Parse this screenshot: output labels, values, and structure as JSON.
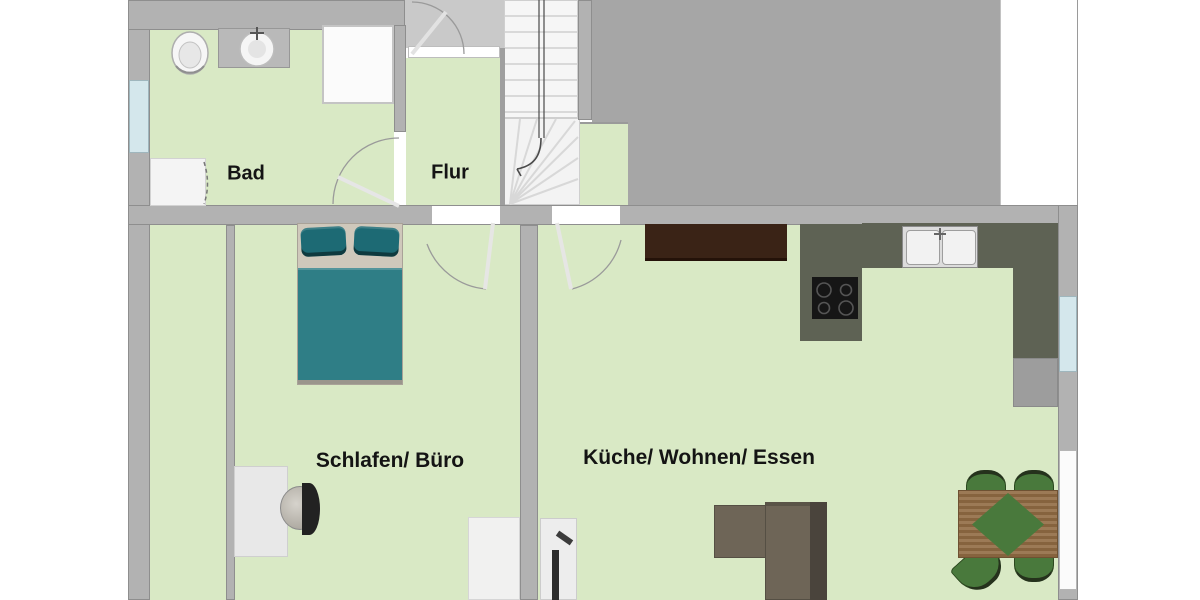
{
  "plan_title": "Apartment floor plan",
  "rooms": {
    "bad_label": "Bad",
    "flur_label": "Flur",
    "schlafen_label": "Schlafen/ Büro",
    "kueche_label": "Küche/ Wohnen/ Essen"
  },
  "colors": {
    "floor_green": "#d9e9c5",
    "wall_gray": "#b2b2b2",
    "wall_edge": "#8e8e8e",
    "block_gray": "#a6a6a6",
    "vestibule_gray": "#c9c9c9",
    "window_blue": "#d4e7ec",
    "bed_teal": "#2f7e86",
    "pillow_teal": "#1d6a74",
    "headboard_beige": "#cfc8bb",
    "counter_olive": "#5e6254",
    "sideboard_brown": "#3a2316",
    "sofa_taupe": "#6e6557",
    "sofa_dark": "#4a443c",
    "table_wood": "#916b43",
    "chair_green": "#49793c",
    "chair_dark": "#25321c",
    "cooktop_black": "#161616"
  }
}
